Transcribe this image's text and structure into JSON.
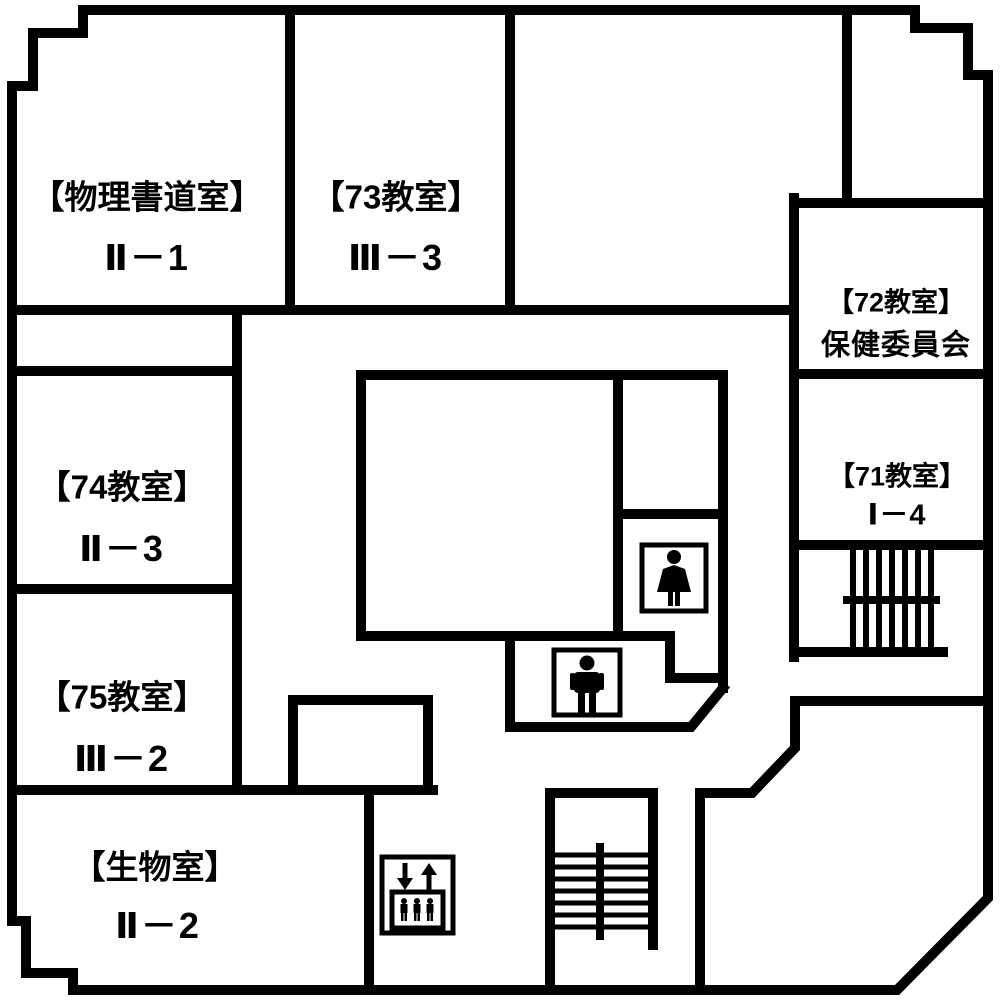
{
  "title": "school-floor-plan",
  "colors": {
    "wall": "#000000",
    "background": "#ffffff",
    "text": "#000000"
  },
  "rooms": [
    {
      "id": "physics-calligraphy-room",
      "name": "【物理書道室】",
      "class_label": "Ⅱ－1"
    },
    {
      "id": "room-73",
      "name": "【73教室】",
      "class_label": "Ⅲ－3"
    },
    {
      "id": "room-72",
      "name": "【72教室】",
      "class_label": "保健委員会"
    },
    {
      "id": "room-71",
      "name": "【71教室】",
      "class_label": "Ⅰ－4"
    },
    {
      "id": "room-74",
      "name": "【74教室】",
      "class_label": "Ⅱ－3"
    },
    {
      "id": "room-75",
      "name": "【75教室】",
      "class_label": "Ⅲ－2"
    },
    {
      "id": "biology-room",
      "name": "【生物室】",
      "class_label": "Ⅱ－2"
    }
  ],
  "icons": [
    {
      "name": "woman-icon",
      "meaning": "womens restroom pictogram"
    },
    {
      "name": "man-icon",
      "meaning": "mens restroom pictogram"
    },
    {
      "name": "elevator-icon",
      "meaning": "elevator with up/down arrows pictogram"
    },
    {
      "name": "stairs-upper-icon",
      "meaning": "staircase (east wing)"
    },
    {
      "name": "stairs-lower-icon",
      "meaning": "staircase (south wing)"
    }
  ]
}
